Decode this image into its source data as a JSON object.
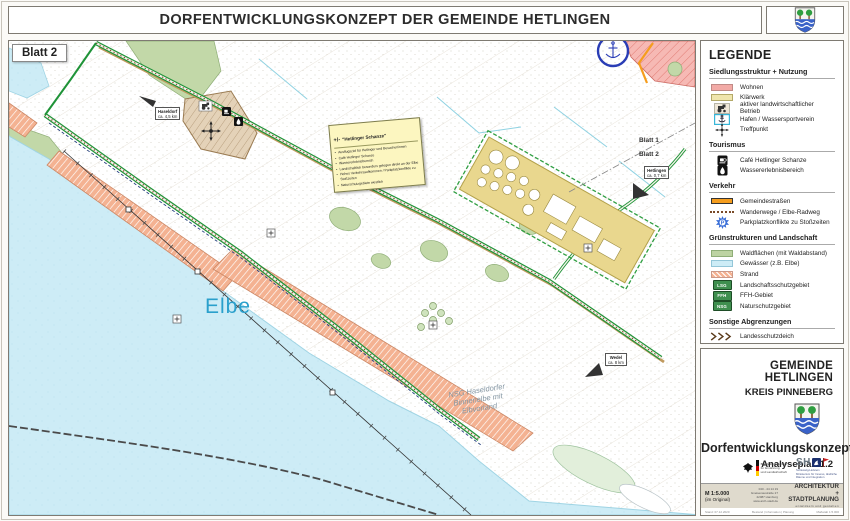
{
  "header": {
    "title": "DORFENTWICKLUNGSKONZEPT DER GEMEINDE HETLINGEN"
  },
  "map": {
    "sheet_badge": "Blatt 2",
    "labels": {
      "elbe": "Elbe",
      "nsg_line1": "NSG Haseldorfer",
      "nsg_line2": "Binnenelbe mit",
      "nsg_line3": "Elbvorland",
      "sheet1": "Blatt 1",
      "sheet2": "Blatt 2",
      "hetlingen_name": "Hetlingen",
      "hetlingen_dist": "ca. 0,7 km",
      "wedel_name": "Wedel",
      "wedel_dist": "ca. 8 km",
      "haseldorf_name": "Haseldorf",
      "haseldorf_dist": "ca. 4,5 km"
    },
    "note_box": {
      "title_sign": "+/-",
      "title": "\"Hetlinger Schanze\"",
      "bullets": [
        "Ausflugsziel für Hetlinger und Besucher/innen",
        "Café Hetlinger Schanze",
        "Wassererlebnisbereich",
        "Landschaftlich besonders gelegen direkt an der Elbe",
        "Hohes Verkehrsaufkommen / Parkplatzkonflikte zu Stoßzeiten",
        "Naturschutzgebiete westlich"
      ]
    }
  },
  "legend": {
    "title": "LEGENDE",
    "parking_letter": "P",
    "sections": [
      {
        "heading": "Siedlungsstruktur + Nutzung",
        "items": [
          {
            "label": "Wohnen"
          },
          {
            "label": "Klärwerk"
          },
          {
            "label": "aktiver landwirtschaftlicher Betrieb"
          },
          {
            "label": "Hafen / Wassersportverein"
          },
          {
            "label": "Treffpunkt"
          }
        ]
      },
      {
        "heading": "Tourismus",
        "items": [
          {
            "label": "Café Hetlinger Schanze"
          },
          {
            "label": "Wassererlebnisbereich"
          }
        ]
      },
      {
        "heading": "Verkehr",
        "items": [
          {
            "label": "Gemeindestraßen"
          },
          {
            "label": "Wanderwege / Elbe-Radweg"
          },
          {
            "label": "Parkplatzkonflikte zu Stoßzeiten"
          }
        ]
      },
      {
        "heading": "Grünstrukturen und Landschaft",
        "items": [
          {
            "label": "Waldflächen (mit Waldabstand)"
          },
          {
            "label": "Gewässer (z.B. Elbe)"
          },
          {
            "label": "Strand"
          },
          {
            "label": "Landschaftsschutzgebiet",
            "abbr": "LSG"
          },
          {
            "label": "FFH-Gebiet",
            "abbr": "FFH"
          },
          {
            "label": "Naturschutzgebiet",
            "abbr": "NSG"
          }
        ]
      },
      {
        "heading": "Sonstige Abgrenzungen",
        "items": [
          {
            "label": "Landesschutzdeich"
          },
          {
            "label": "Hochspannungsleitung"
          },
          {
            "label": "Gemeindegrenze"
          }
        ]
      }
    ]
  },
  "titleblock": {
    "municipality": "GEMEINDE HETLINGEN",
    "district": "KREIS PINNEBERG",
    "plan_title": "Dorfentwicklungskonzept",
    "plan_subtitle": "Analyseplan 1.2",
    "funder_federal_line1": "Bundesministerium",
    "funder_federal_line2": "für Ernährung",
    "funder_federal_line3": "und Landwirtschaft",
    "funder_state_abbr": "SH",
    "funder_state_line1": "Schleswig-Holstein",
    "funder_state_line2": "Ministerium für Inneres, ländliche",
    "funder_state_line3": "Räume und Integration",
    "scale": "M 1:5.000",
    "scale_note": "(im Original)",
    "contact_line1": "040 - 44 14 19",
    "contact_line2": "Gneisenaustraße 27",
    "contact_line3": "22087 Hamburg",
    "contact_line4": "www.arch-stadt.de",
    "office_name_line1": "ARCHITEKTUR",
    "office_name_line2": "+ STADTPLANUNG",
    "office_tagline": "entwickeln und gestalten",
    "footnote_left": "Stand: 07.12.2020",
    "footnote_center": "Bestand | Information | Planung",
    "footnote_right": "Maßstab 1:5.000"
  },
  "colors": {
    "water": "#cdecf6",
    "wohnen": "#f2aaa6",
    "klaerwerk": "#e9d78e",
    "wald": "#bdd3a2",
    "strand": "#f4b292",
    "road_orange": "#f59d1e",
    "dike_green": "#1f9338"
  }
}
